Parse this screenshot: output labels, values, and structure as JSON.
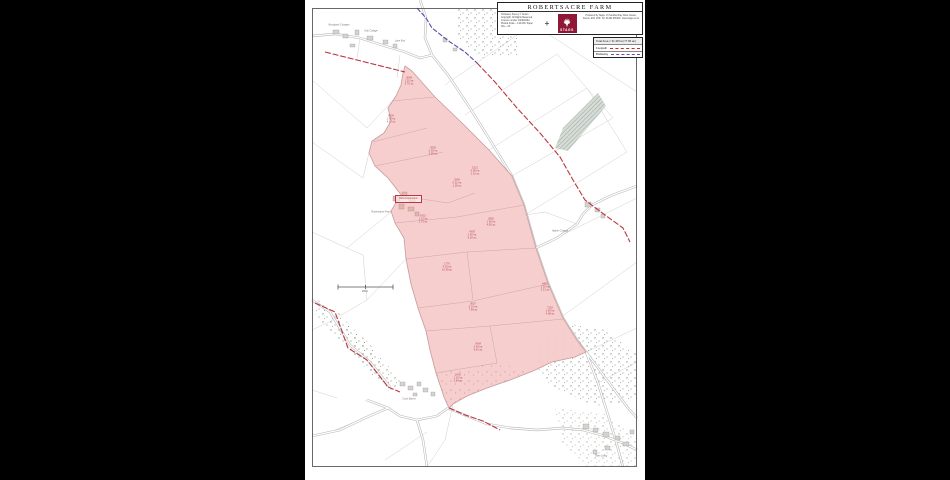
{
  "window": {
    "background": "#000000",
    "page_background": "#ffffff"
  },
  "title_block": {
    "title": "ROBERTSACRE FARM",
    "north_symbol": "+",
    "left_text_lines": "Ordnance Survey © Crown Copyright. All Rights Reserved. Licence number 100022432. Plotted Scale - 1:10,000. Paper Size - A4",
    "right_text_lines": "Produced by Stags. 21 Southernhay West, Exeter, Devon, EX1 1PR. Tel: 01392 255202. www.stags.co.uk",
    "logo": {
      "text": "STAGS",
      "color": "#8f1838",
      "icon": "stag-icon"
    }
  },
  "legend": {
    "total_area": "Total Area = 31.38 ha (77.56 ac)",
    "footpath_label": "Footpath",
    "bridleway_label": "Bridleway",
    "footpath_color": "#cc2a2a",
    "bridleway_color": "#5b4ea6"
  },
  "map": {
    "colors": {
      "holding_fill": "#f6c9c9",
      "holding_edge": "#c59a9a",
      "footpath": "#bb3640",
      "bridleway": "#5b4ea6",
      "road": "#b5b5b5",
      "field_line": "#cfcfcf",
      "woodland_dot": "#8b9a8b",
      "building": "#d8d2ce"
    },
    "farm_box_label": "Robertsacre Farm",
    "scale_bar_label": "200m",
    "parcels": [
      {
        "x": 104,
        "y": 82,
        "id": "0048",
        "ha": "1.52 ha",
        "ac": "3.76 ac"
      },
      {
        "x": 86,
        "y": 120,
        "id": "9834",
        "ha": "1.85 ha",
        "ac": "4.57 ac"
      },
      {
        "x": 128,
        "y": 152,
        "id": "0925",
        "ha": "2.30 ha",
        "ac": "5.68 ac"
      },
      {
        "x": 170,
        "y": 172,
        "id": "1513",
        "ha": "0.85 ha",
        "ac": "2.10 ac"
      },
      {
        "x": 152,
        "y": 184,
        "id": "2546",
        "ha": "0.52 ha",
        "ac": "1.28 ac"
      },
      {
        "x": 118,
        "y": 220,
        "id": "8715",
        "ha": "1.10 ha",
        "ac": "2.72 ac"
      },
      {
        "x": 186,
        "y": 223,
        "id": "2805",
        "ha": "1.95 ha",
        "ac": "4.82 ac"
      },
      {
        "x": 167,
        "y": 236,
        "id": "4393",
        "ha": "2.45 ha",
        "ac": "6.05 ac"
      },
      {
        "x": 142,
        "y": 268,
        "id": "1776",
        "ha": "4.20 ha",
        "ac": "10.38 ac"
      },
      {
        "x": 240,
        "y": 288,
        "id": "6467",
        "ha": "1.30 ha",
        "ac": "3.21 ac"
      },
      {
        "x": 168,
        "y": 308,
        "id": "3657",
        "ha": "3.10 ha",
        "ac": "7.66 ac"
      },
      {
        "x": 245,
        "y": 312,
        "id": "7252",
        "ha": "1.65 ha",
        "ac": "4.08 ac"
      },
      {
        "x": 173,
        "y": 348,
        "id": "3434",
        "ha": "2.60 ha",
        "ac": "6.42 ac"
      },
      {
        "x": 153,
        "y": 379,
        "id": "2433",
        "ha": "1.15 ha",
        "ac": "2.84 ac"
      }
    ],
    "place_labels": [
      {
        "x": 34,
        "y": 25,
        "t": "Woodpark Cottages"
      },
      {
        "x": 66,
        "y": 31,
        "t": "Oak Cottage"
      },
      {
        "x": 95,
        "y": 41,
        "t": "Lane End"
      },
      {
        "x": 76,
        "y": 212,
        "t": "Robertsacre Farm"
      },
      {
        "x": 255,
        "y": 231,
        "t": "Higher Cottage"
      },
      {
        "x": 104,
        "y": 399,
        "t": "Court Barton"
      },
      {
        "x": 296,
        "y": 456,
        "t": "Town Living"
      }
    ]
  }
}
